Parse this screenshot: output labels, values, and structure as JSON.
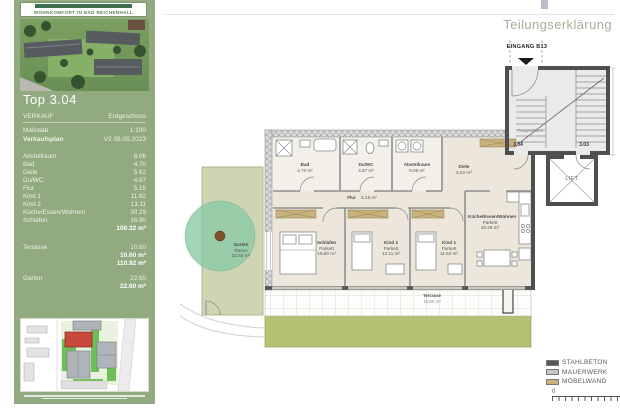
{
  "header": {
    "title": "Teilungserklärung"
  },
  "sidebar": {
    "slogan": "WOHNKOMFORT IN BAD REICHENHALL",
    "unit": "Top 3.04",
    "info": [
      {
        "label": "VERKAUF",
        "value": "Erdgeschoss"
      },
      {
        "label": "Maßstab",
        "value": "1:100"
      },
      {
        "label": "Verkaufsplan",
        "value": "V2  08.05.2023"
      }
    ],
    "rooms": [
      {
        "label": "Abstellraum",
        "value": "8.06"
      },
      {
        "label": "Bad",
        "value": "4.70"
      },
      {
        "label": "Diele",
        "value": "5.62"
      },
      {
        "label": "Du/WC",
        "value": "4.87"
      },
      {
        "label": "Flur",
        "value": "5.15"
      },
      {
        "label": "Kind 1",
        "value": "11.62"
      },
      {
        "label": "Kind 2",
        "value": "13.11"
      },
      {
        "label": "Küche/Essen/Wohnen",
        "value": "30.29"
      },
      {
        "label": "Schlafen",
        "value": "16.90"
      }
    ],
    "total_living": "100.32 m²",
    "terrasse": {
      "label": "Terrasse",
      "value": "10.60",
      "subtotal": "10.60 m²",
      "grand_total": "110.92 m²"
    },
    "garten": {
      "label": "Garten",
      "value": "22.60",
      "subtotal": "22.60 m²"
    }
  },
  "plan": {
    "entrance_label": "EINGANG B13",
    "stairwell_label": "Treppenhaus",
    "lift_label": "LIFT",
    "door_304": "3.04",
    "door_303": "3.03",
    "rooms": {
      "bad": {
        "name": "Bad",
        "area": "4.70 m²"
      },
      "duwc": {
        "name": "Du/WC",
        "area": "4.87 m²"
      },
      "abstellraum": {
        "name": "Abstellraum",
        "area": "8.06 m²"
      },
      "diele": {
        "name": "Diele",
        "area": "5.62 m²"
      },
      "flur": {
        "name": "Flur",
        "area": "5.15 m²"
      },
      "schlafen": {
        "name": "Schlafen",
        "floor": "Parkett",
        "area": "16.90 m²"
      },
      "kind2": {
        "name": "Kind 2",
        "floor": "Parkett",
        "area": "13.11 m²"
      },
      "kind1": {
        "name": "Kind 1",
        "floor": "Parkett",
        "area": "11.62 m²"
      },
      "kueche": {
        "name": "Küche/Essen/Wohnen",
        "floor": "Parkett",
        "area": "30.29 m²"
      },
      "terrasse": {
        "name": "Terrasse",
        "area": "10.60 m²"
      },
      "garten": {
        "name": "Garten",
        "floor": "Rasen",
        "area": "22.60 m²"
      }
    }
  },
  "legend": {
    "items": [
      {
        "label": "STAHLBETON",
        "color": "#585858"
      },
      {
        "label": "MAUERWERK",
        "color": "#c6c6c6"
      },
      {
        "label": "MÖBELWAND",
        "color": "#c9b27e"
      }
    ],
    "scale_zero": "0"
  },
  "colors": {
    "sidebar_green": "#92aa80",
    "lawn_green": "#b6c173",
    "tree_green": "#8cc9a6",
    "highlight_red": "#c74a3c"
  }
}
